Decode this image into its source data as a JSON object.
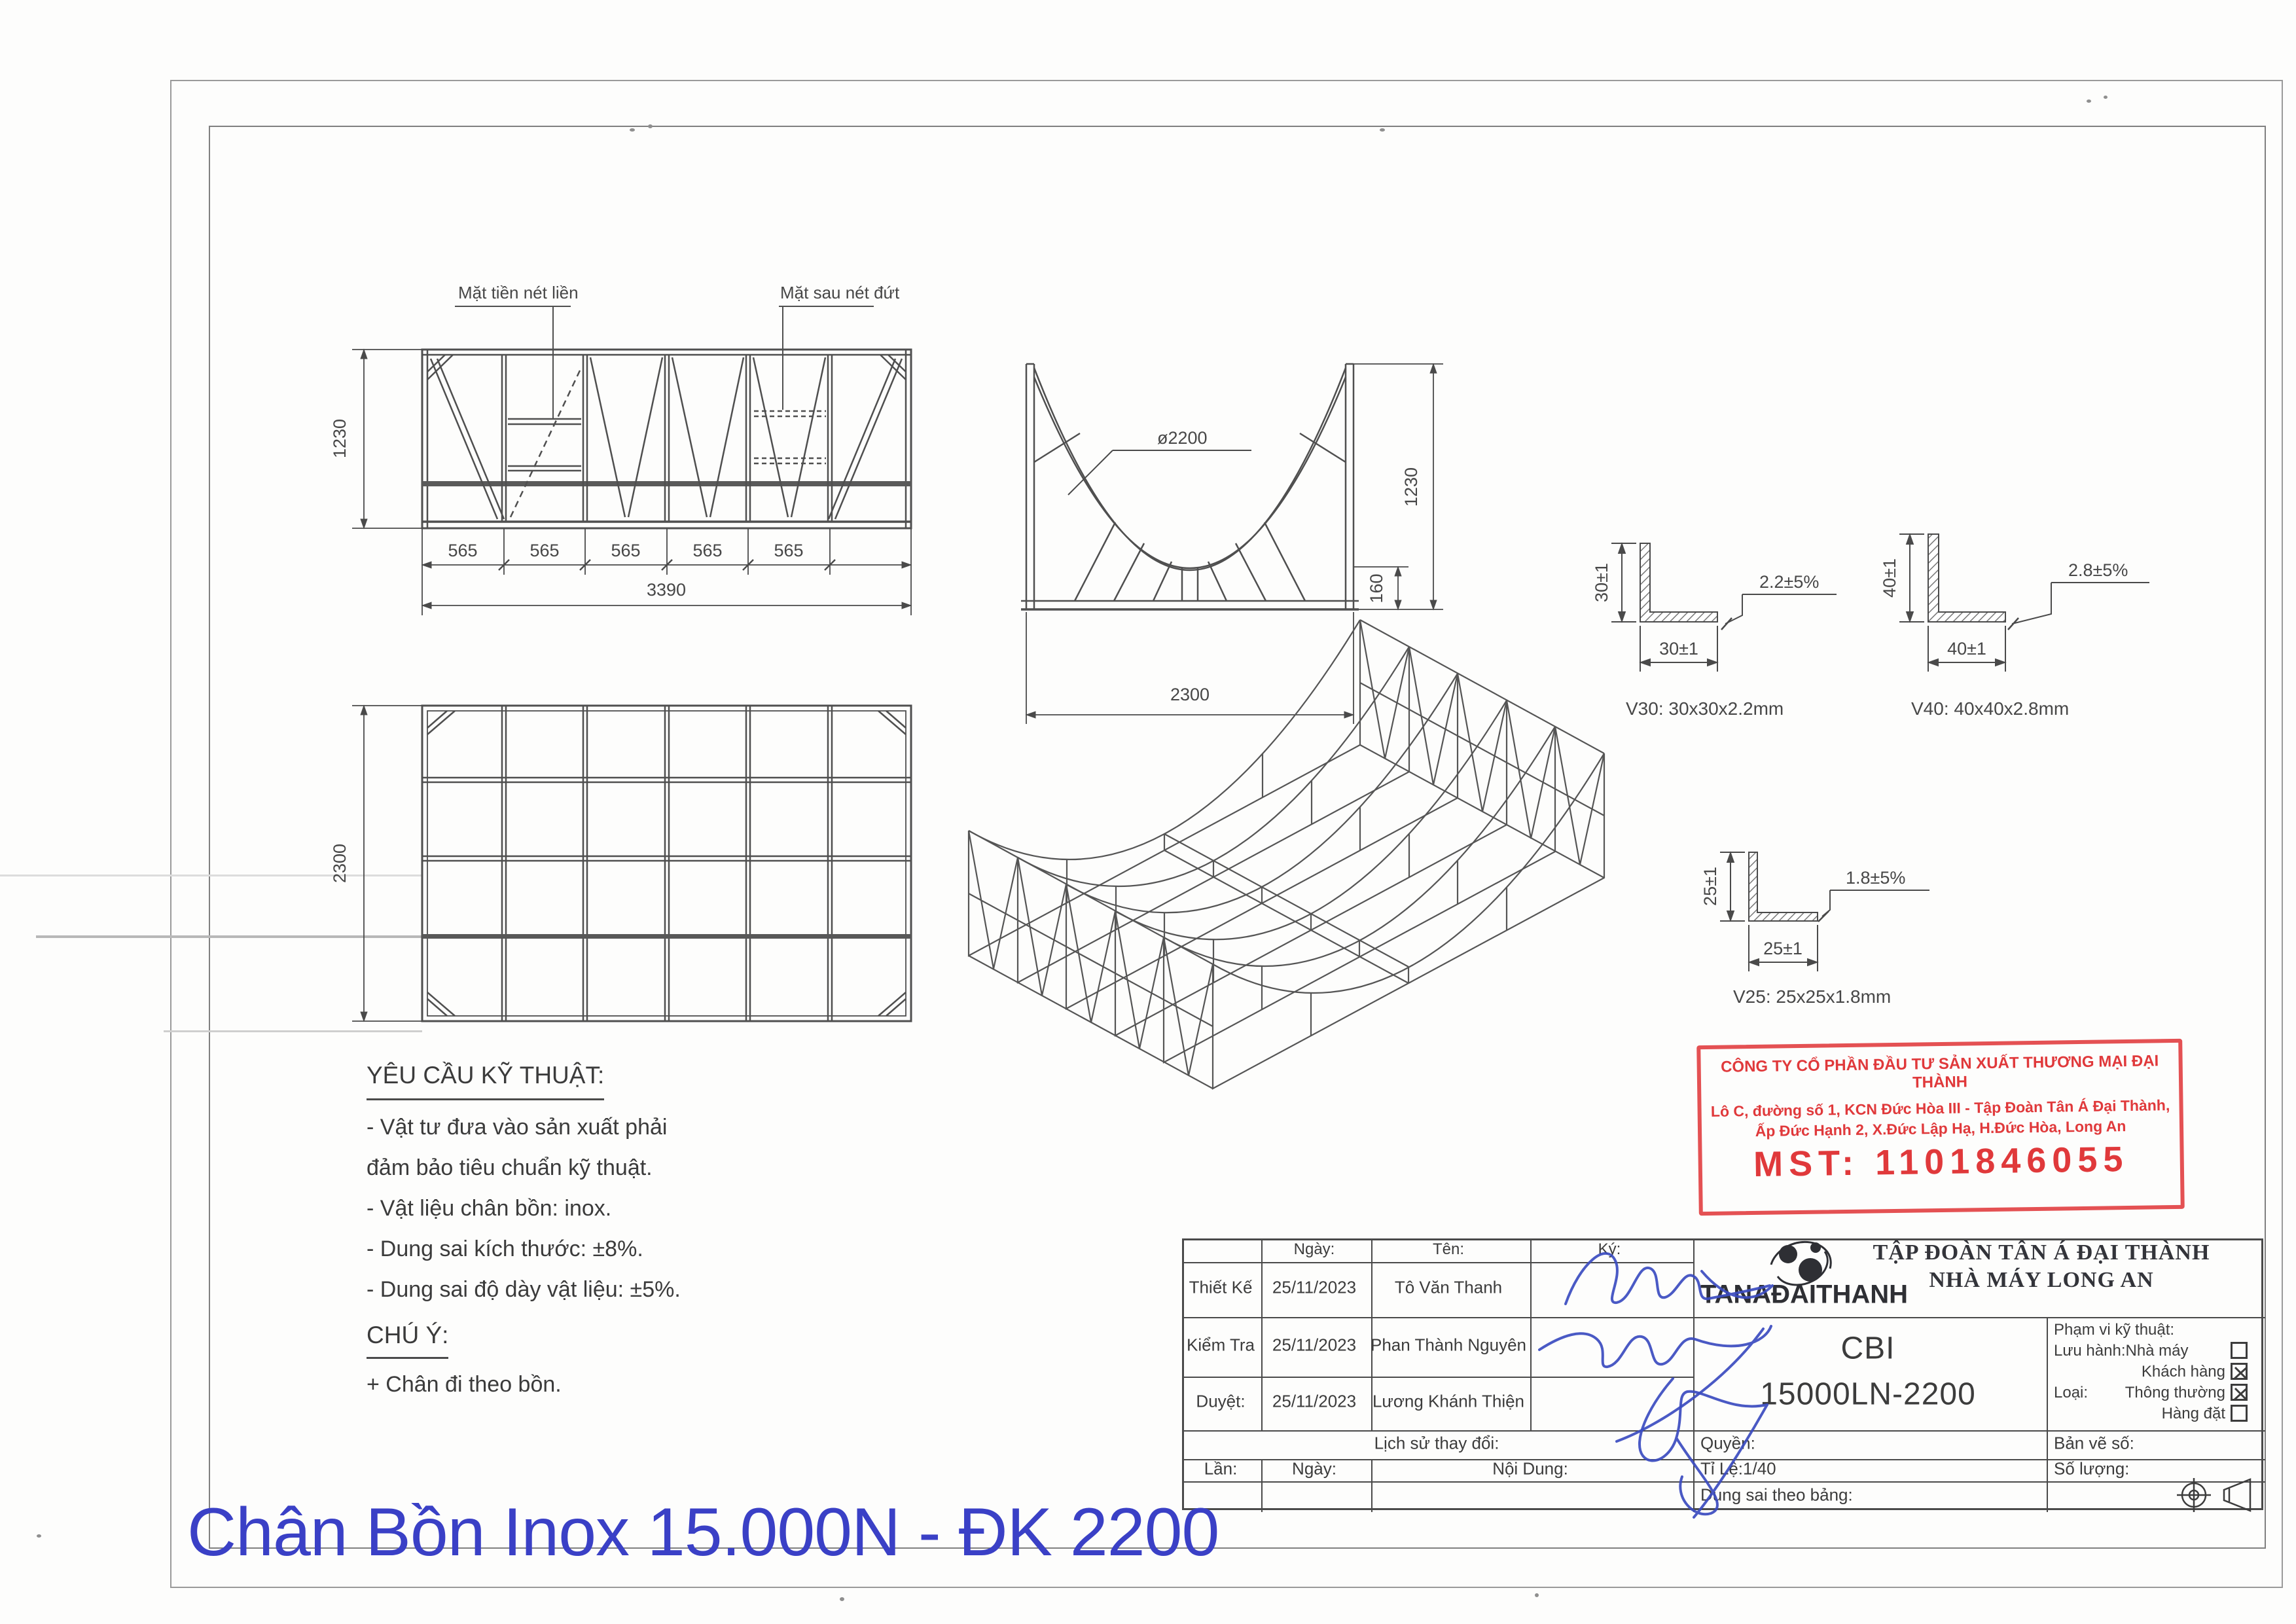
{
  "page": {
    "bg": "#fdfdfc",
    "line_color": "#4f4f4f",
    "accent_blue": "#3a40c6",
    "stamp_red": "#e0393b",
    "signature_blue": "#3b4cc0"
  },
  "front_view": {
    "label_front": "Mặt tiền nét liền",
    "label_rear": "Mặt sau nét đứt",
    "height_dim": "1230",
    "segment_dims": [
      "565",
      "565",
      "565",
      "565",
      "565"
    ],
    "total_dim": "3390"
  },
  "section_view": {
    "diameter": "ø2200",
    "height_dim": "1230",
    "base_height_dim": "160",
    "width_dim": "2300"
  },
  "top_view": {
    "depth_dim": "2300"
  },
  "profiles": [
    {
      "id": "V30",
      "v_dim": "30±1",
      "h_dim": "30±1",
      "t_dim": "2.2±5%",
      "caption": "V30: 30x30x2.2mm"
    },
    {
      "id": "V40",
      "v_dim": "40±1",
      "h_dim": "40±1",
      "t_dim": "2.8±5%",
      "caption": "V40: 40x40x2.8mm"
    },
    {
      "id": "V25",
      "v_dim": "25±1",
      "h_dim": "25±1",
      "t_dim": "1.8±5%",
      "caption": "V25: 25x25x1.8mm"
    }
  ],
  "notes": {
    "heading": "YÊU CẦU KỸ THUẬT:",
    "items": [
      "- Vật tư đưa vào sản xuất phải",
      "đảm bảo tiêu chuẩn kỹ thuật.",
      "- Vật liệu chân bồn: inox.",
      "- Dung sai kích thước: ±8%.",
      "- Dung sai độ dày vật liệu: ±5%."
    ],
    "note_heading": "CHÚ Ý:",
    "note_item": "+ Chân đi theo bồn."
  },
  "stamp": {
    "line1": "CÔNG TY CỔ PHẦN ĐẦU TƯ SẢN XUẤT THƯƠNG MẠI ĐẠI THÀNH",
    "line2": "Lô C, đường số 1, KCN Đức Hòa III - Tập Đoàn Tân Á Đại Thành,",
    "line3": "Ấp Đức Hạnh 2, X.Đức Lập Hạ, H.Đức Hòa, Long An",
    "mst": "MST: 1101846055"
  },
  "titleblock": {
    "header": {
      "ngay": "Ngày:",
      "ten": "Tên:",
      "ky": "Ký:"
    },
    "rows": [
      {
        "label": "Thiết Kế",
        "date": "25/11/2023",
        "name": "Tô Văn Thanh"
      },
      {
        "label": "Kiểm Tra",
        "date": "25/11/2023",
        "name": "Phan Thành Nguyên"
      },
      {
        "label": "Duyệt:",
        "date": "25/11/2023",
        "name": "Lương Khánh Thiện"
      }
    ],
    "history_label": "Lịch sử thay đổi:",
    "lan": "Lần:",
    "ngay2": "Ngày:",
    "noi_dung": "Nội Dung:",
    "quyen": "Quyền:",
    "ban_ve_so": "Bản vẽ số:",
    "ti_le": "Tỉ Lệ:1/40",
    "so_luong": "Số lượng:",
    "dung_sai": "Dung sai theo bảng:",
    "company": {
      "logo_text": "TANAĐAITHANH",
      "line1": "TẬP ĐOÀN TÂN Á ĐẠI THÀNH",
      "line2": "NHÀ MÁY LONG AN"
    },
    "product": {
      "line1": "CBI",
      "line2": "15000LN-2200"
    },
    "scope": {
      "title": "Phạm vi kỹ thuật:",
      "rows": [
        {
          "label": "Lưu hành:Nhà máy",
          "checked": false
        },
        {
          "label": "Khách hàng",
          "checked": true
        },
        {
          "prefix": "Loại:",
          "label": "Thông thường",
          "checked": true
        },
        {
          "label": "Hàng đặt",
          "checked": false
        }
      ]
    }
  },
  "footer_title": "Chân Bồn Inox 15.000N - ĐK 2200"
}
